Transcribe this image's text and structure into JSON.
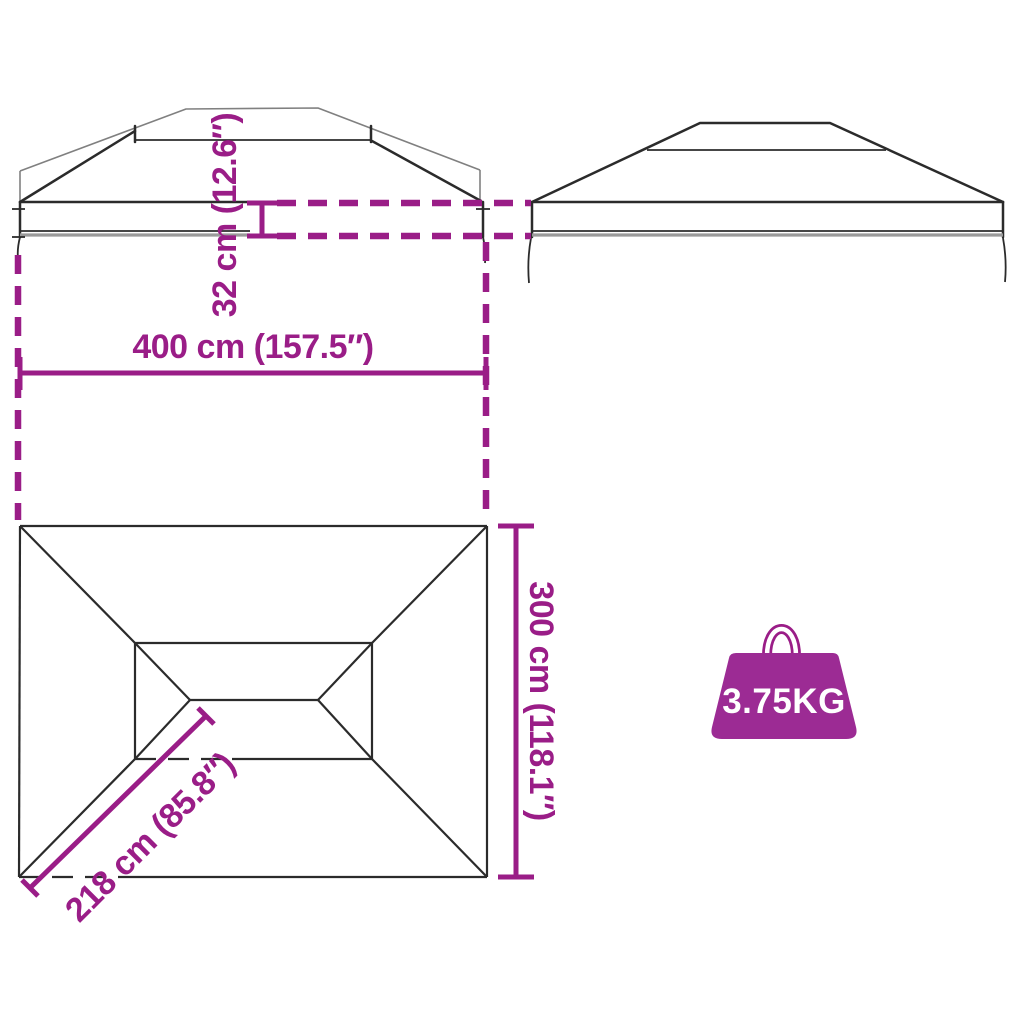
{
  "diagram": {
    "dimensions": {
      "roof_height": "32 cm (12.6″)",
      "width": "400 cm (157.5″)",
      "depth": "300 cm (118.1″)",
      "corner_length": "218 cm (85.8″)"
    },
    "weight": "3.75KG"
  },
  "colors": {
    "accent": "#9a1d87",
    "outline": "#2b2b2b",
    "thin_outline": "#808080",
    "band_shadow": "#9a9a9a",
    "weight_icon_fill": "#9c2b94",
    "weight_label": "#ffffff",
    "background": "#ffffff"
  },
  "icons": {
    "weight": "weight-icon"
  }
}
